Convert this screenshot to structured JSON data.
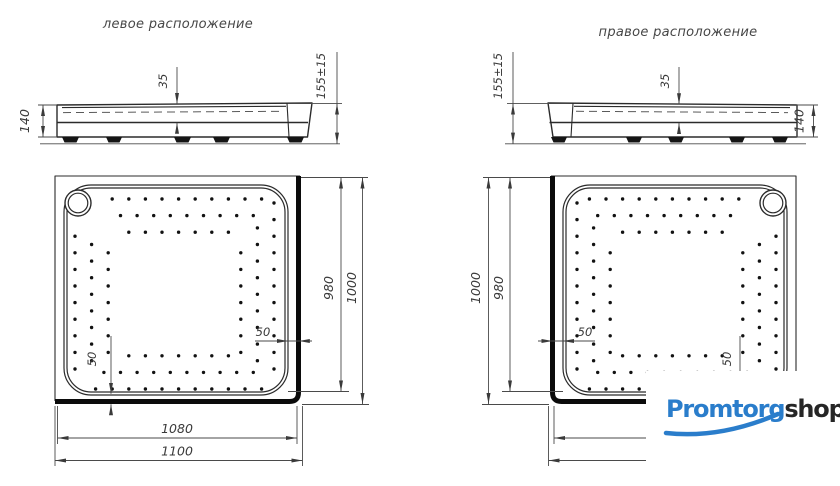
{
  "canvas": {
    "bg": "#ffffff",
    "line_color": "#2b2b2b",
    "dim_color": "#3a3a3a"
  },
  "drawings": {
    "left": {
      "title": "левое расположение",
      "side_view": {
        "height": "140",
        "basin_depth": "35",
        "total_height": "155±15"
      },
      "plan_view": {
        "inner_width": "1080",
        "outer_width": "1100",
        "inner_length": "980",
        "outer_length": "1000",
        "rim_width_right": "50",
        "rim_width_bottom": "50"
      }
    },
    "right": {
      "title": "правое расположение",
      "side_view": {
        "height": "140",
        "basin_depth": "35",
        "total_height": "155±15"
      },
      "plan_view": {
        "inner_length": "980",
        "outer_length": "1000",
        "rim_width_left": "50",
        "rim_width_bottom": "50"
      }
    }
  },
  "logo": {
    "text_blue": "Promtorg",
    "text_dark": "shop",
    "blue": "#2a7dcb",
    "dark": "#262626"
  },
  "dot_pattern": {
    "rings": 3,
    "step": 16.6,
    "stagger": 8.3,
    "start_offset": 4,
    "dot_radius": 1.7,
    "band": {
      "x0": 75,
      "y0": 199,
      "x1": 274,
      "y1": 389
    },
    "clip": {
      "x0": 70,
      "y0": 191,
      "x1": 285,
      "y1": 392,
      "r": 23
    },
    "drain": {
      "x": 78,
      "y": 203,
      "skip": 16
    },
    "mirror_axis": 851
  }
}
